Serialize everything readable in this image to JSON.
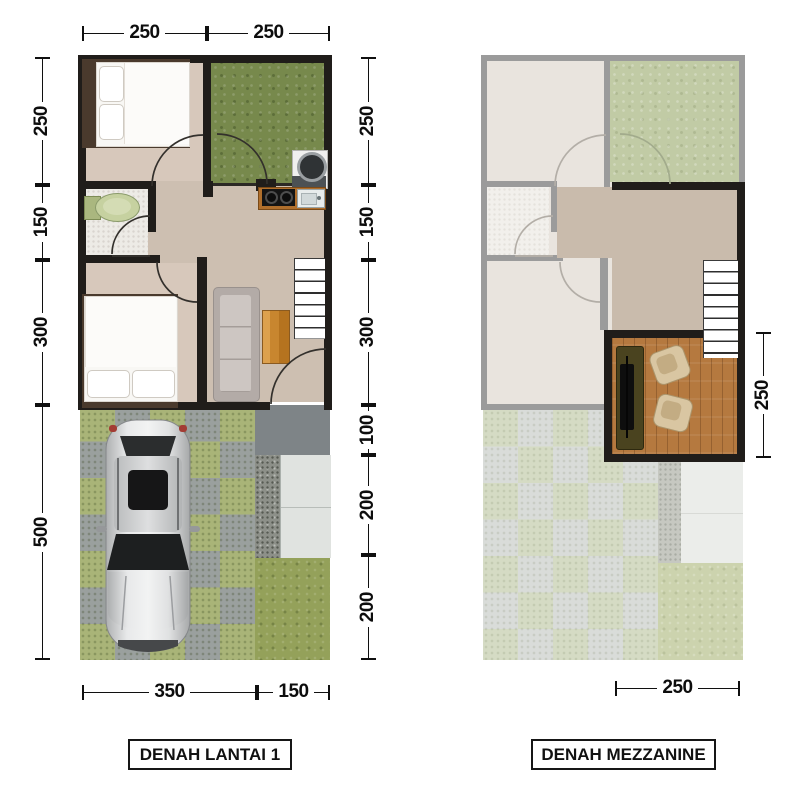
{
  "floor1": {
    "title": "DENAH LANTAI 1",
    "dim_top": [
      "250",
      "250"
    ],
    "dim_left": [
      "250",
      "150",
      "300",
      "500"
    ],
    "dim_right": [
      "250",
      "150",
      "300",
      "100",
      "200",
      "200"
    ],
    "dim_bottom": [
      "350",
      "150"
    ]
  },
  "mezzanine": {
    "title": "DENAH MEZZANINE",
    "dim_right": [
      "250"
    ],
    "dim_bottom": [
      "250"
    ]
  },
  "colors": {
    "wall": "#201d1a",
    "faded_wall": "#9b9b9b",
    "floor_living": "#cdbfb1",
    "floor_bedroom": "#d7c8bb",
    "garden_green": "#77894c",
    "garden_green_faded": "#c1cba5",
    "mezzanine_floor": "#c9bbac",
    "wood_floor": "#b5793f",
    "paver_green": "#a9b478",
    "paver_gray": "#9aa09e",
    "pavement_gray": "#7e8487",
    "grass": "#94a15a",
    "dimension_text": "#0d0d0d"
  },
  "icons": [
    "bed-icon",
    "toilet-icon",
    "door-arc-icon",
    "stairs-icon",
    "sofa-icon",
    "coffee-table-icon",
    "stove-icon",
    "sink-icon",
    "washing-machine-icon",
    "car-icon",
    "tv-desk-icon",
    "armchair-icon"
  ]
}
